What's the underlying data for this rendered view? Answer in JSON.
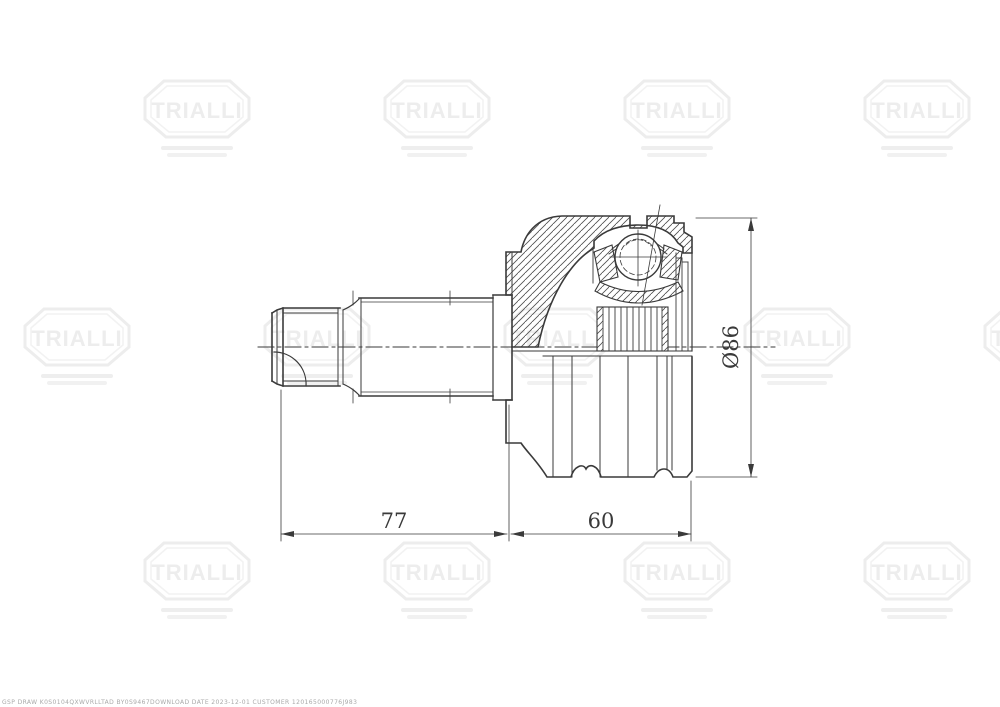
{
  "drawing": {
    "dimensions": {
      "shaft_length": "77",
      "joint_length": "60",
      "outer_diameter": "Ø86"
    }
  },
  "watermark": {
    "brand": "TRIALLI"
  },
  "footer": {
    "watermark_code": "GSP DRAW K0S0104QXWVRLLTAD BY0S9467DOWNLOAD DATE 2023-12-01 CUSTOMER 120165000776J983"
  },
  "colors": {
    "line": "#3a3a3a",
    "watermark": "#ededed"
  }
}
